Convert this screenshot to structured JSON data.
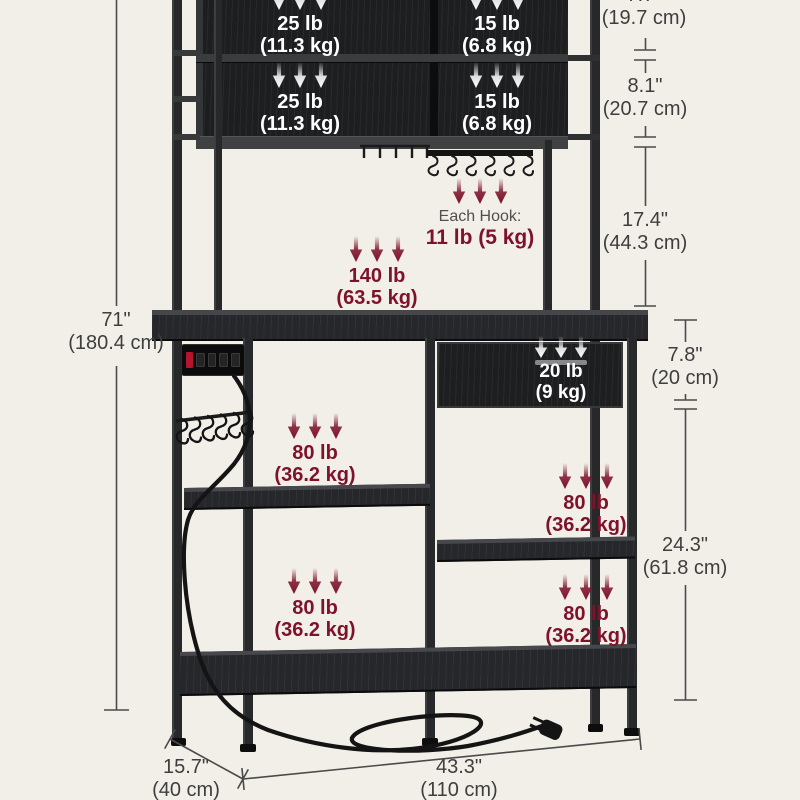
{
  "colors": {
    "background": "#f2efe9",
    "accent_maroon": "#7d122a",
    "furniture_black": "#1d1e20",
    "dimension_text": "#3e3e3e",
    "label_white": "#ffffff"
  },
  "capacities": {
    "hutch_top_left": {
      "value": "25 lb",
      "metric": "(11.3 kg)"
    },
    "hutch_top_right": {
      "value": "15 lb",
      "metric": "(6.8 kg)"
    },
    "hutch_bottom_left": {
      "value": "25 lb",
      "metric": "(11.3 kg)"
    },
    "hutch_bottom_right": {
      "value": "15 lb",
      "metric": "(6.8 kg)"
    },
    "hooks": {
      "label": "Each Hook:",
      "value": "11 lb (5 kg)"
    },
    "countertop": {
      "value": "140 lb",
      "metric": "(63.5 kg)"
    },
    "drawer": {
      "value": "20 lb",
      "metric": "(9 kg)"
    },
    "shelf_mid_left": {
      "value": "80 lb",
      "metric": "(36.2 kg)"
    },
    "shelf_mid_right": {
      "value": "80 lb",
      "metric": "(36.2 kg)"
    },
    "shelf_bottom_left": {
      "value": "80 lb",
      "metric": "(36.2 kg)"
    },
    "shelf_bottom_right": {
      "value": "80 lb",
      "metric": "(36.2 kg)"
    }
  },
  "dimensions": {
    "overall_height": {
      "value": "71\"",
      "metric": "(180.4 cm)"
    },
    "top_shelf": {
      "value": "7.7\"",
      "metric": "(19.7 cm)"
    },
    "middle_shelf": {
      "value": "8.1\"",
      "metric": "(20.7 cm)"
    },
    "hutch_clearance": {
      "value": "17.4\"",
      "metric": "(44.3 cm)"
    },
    "drawer_height": {
      "value": "7.8\"",
      "metric": "(20 cm)"
    },
    "lower_clearance": {
      "value": "24.3\"",
      "metric": "(61.8 cm)"
    },
    "depth": {
      "value": "15.7\"",
      "metric": "(40 cm)"
    },
    "width": {
      "value": "43.3\"",
      "metric": "(110 cm)"
    }
  }
}
